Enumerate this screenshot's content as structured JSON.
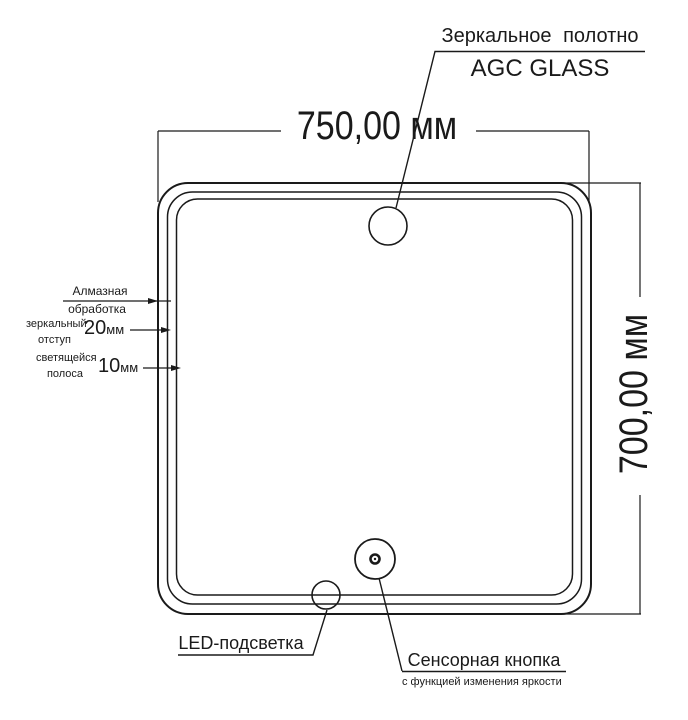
{
  "drawing": {
    "title_callout": {
      "line1": "Зеркальное полотно",
      "line2": "AGC GLASS"
    },
    "dimensions": {
      "width": "750,00 мм",
      "height": "700,00 мм"
    },
    "edge_labels": [
      {
        "line1": "Алмазная",
        "line2": "обработка"
      },
      {
        "line1": "зеркальный",
        "line2": "отступ",
        "value": "20",
        "unit": "мм"
      },
      {
        "line1": "светящейся",
        "line2": "полоса",
        "value": "10",
        "unit": "мм"
      }
    ],
    "led_label": "LED-подсветка",
    "touch_label": {
      "line1": "Сенсорная кнопка",
      "line2": "с функцией изменения яркости"
    },
    "colors": {
      "line": "#1a1a1a",
      "background": "#ffffff"
    }
  }
}
